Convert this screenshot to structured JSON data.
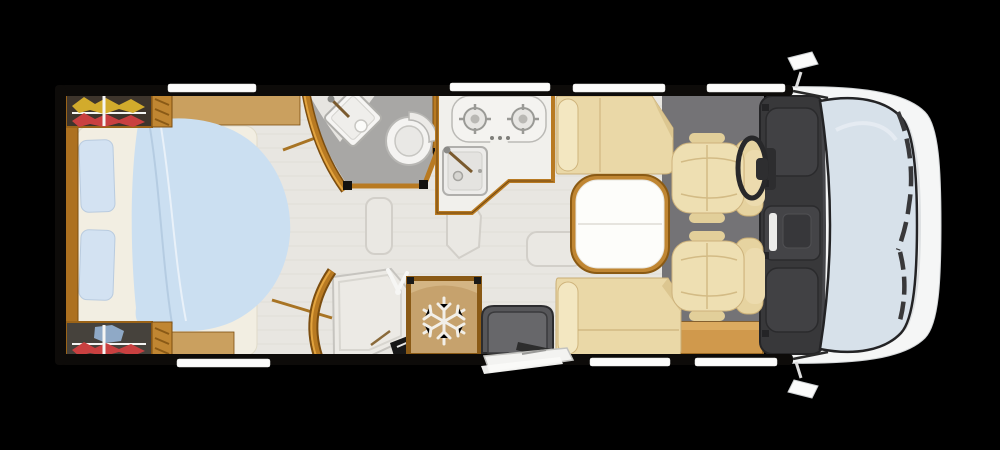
{
  "scene": {
    "kind": "motorhome-floorplan-top-view",
    "cab_orientation": "right"
  },
  "palette": {
    "background": "#000000",
    "wood": "#b87a22",
    "wood-dark": "#7c4e10",
    "wood-light": "#e2a33e",
    "floor": "#e8e6e1",
    "cab-floor": "#747376",
    "duvet": "#cbdff1",
    "mattress": "#f2eee2",
    "bed-pillow": "#d3e2f2",
    "bench": "#ead8a7",
    "chair": "#eedfb2",
    "bath-floor": "#a8a7a5",
    "dash": "#38383a",
    "glass": "#d7e1ea",
    "body": "#f5f6f6",
    "fridge": "#c6a26d",
    "mat": "#57575a",
    "window": "#fcfcfb",
    "table-top": "#fdfdfa",
    "clothes-yellow": "#d2ab2c",
    "clothes-red": "#c94040",
    "clothes-blue": "#8fa9c6"
  },
  "fixtures": {
    "bed": {
      "label": "island-bed"
    },
    "wardrobe_top": {
      "label": "rear-wardrobe-left",
      "clothes": [
        "yellow",
        "red"
      ]
    },
    "wardrobe_bottom": {
      "label": "rear-wardrobe-right",
      "clothes": [
        "blue",
        "red"
      ]
    },
    "bathroom": {
      "label": "washroom-basin-and-toilet"
    },
    "shower": {
      "label": "shower-cubicle"
    },
    "kitchen": {
      "label": "kitchenette-hob-and-sink"
    },
    "fridge": {
      "label": "refrigerator",
      "icon": "snowflake-icon"
    },
    "dinette": {
      "label": "dinette-table-and-benches"
    },
    "cab": {
      "label": "driver-cab"
    },
    "entry": {
      "label": "entrance-door-with-step"
    },
    "windows": {
      "top_count": 4,
      "bottom_count": 3
    }
  }
}
